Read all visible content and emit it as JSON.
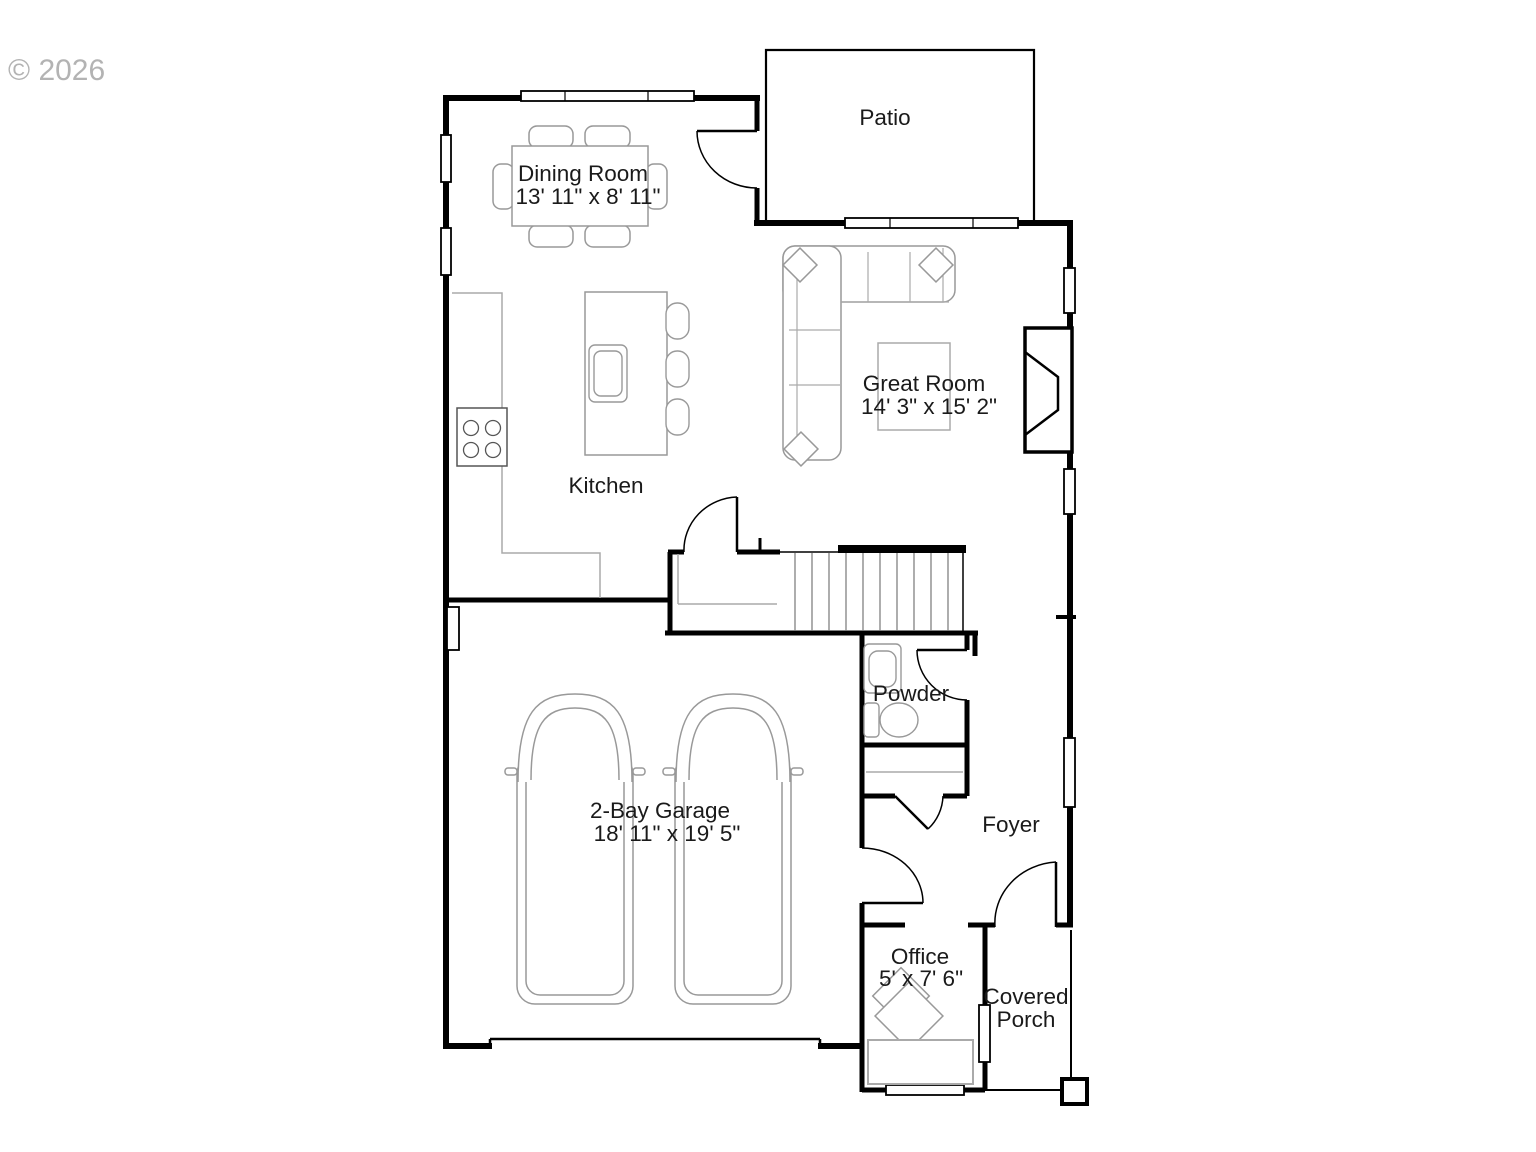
{
  "watermark": "© 2026",
  "colors": {
    "walls": "#000000",
    "furniture": "#999999",
    "labels": "#1a1a1a",
    "watermark": "#b3b3b3",
    "background": "#ffffff"
  },
  "rooms": {
    "patio": {
      "label": "Patio"
    },
    "dining_room": {
      "label": "Dining Room",
      "dimensions": "13' 11\" x 8' 11\""
    },
    "great_room": {
      "label": "Great Room",
      "dimensions": "14' 3\" x 15' 2\""
    },
    "kitchen": {
      "label": "Kitchen"
    },
    "powder": {
      "label": "Powder"
    },
    "garage": {
      "label": "2-Bay Garage",
      "dimensions": "18' 11\" x 19' 5\""
    },
    "foyer": {
      "label": "Foyer"
    },
    "office": {
      "label": "Office",
      "dimensions": "5' x 7' 6\""
    },
    "covered_porch": {
      "label_line1": "Covered",
      "label_line2": "Porch"
    }
  }
}
